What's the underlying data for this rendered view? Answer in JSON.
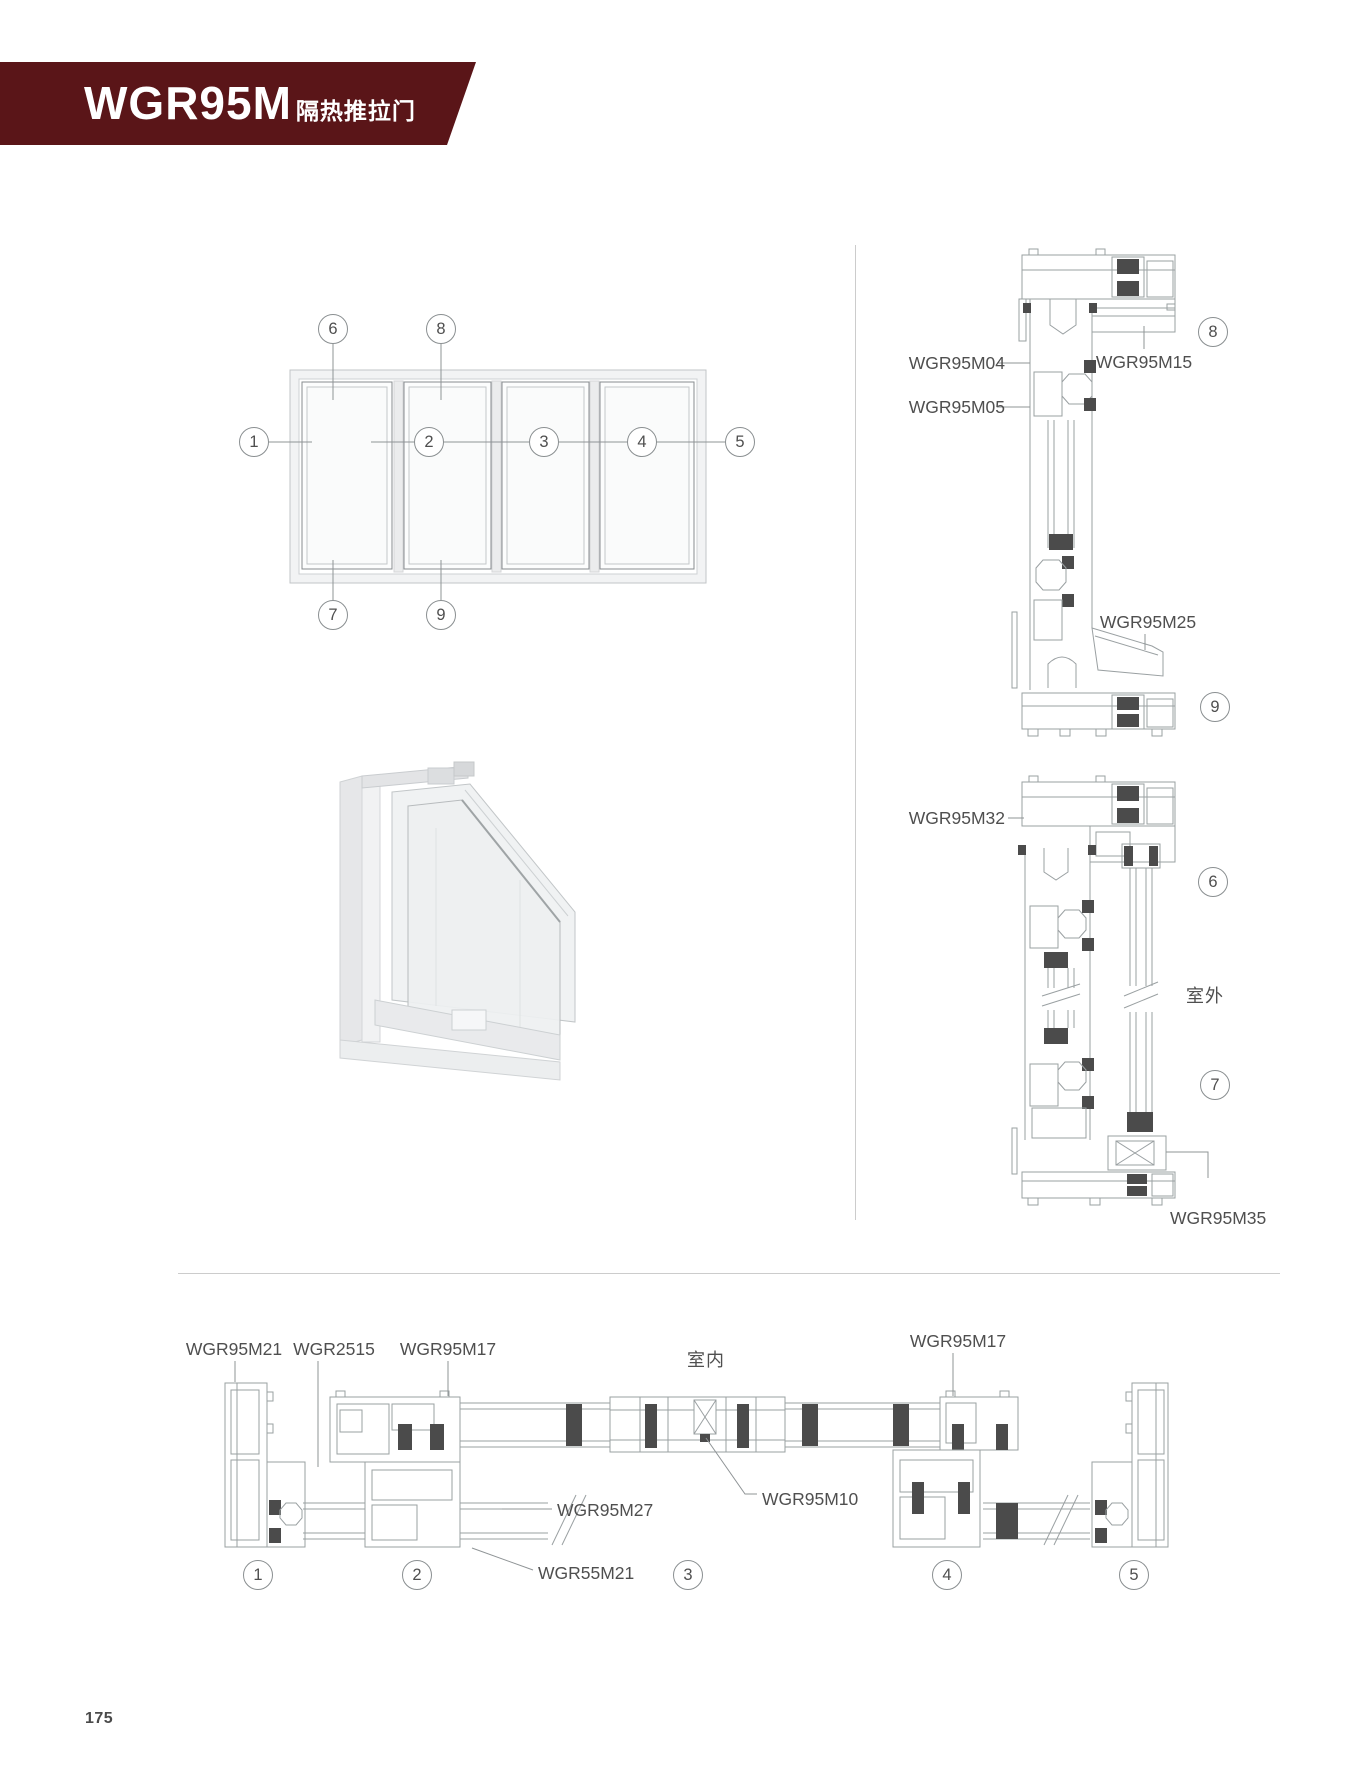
{
  "header": {
    "model": "WGR95M",
    "subtitle": "隔热推拉门",
    "banner_color": "#5a1518"
  },
  "page": {
    "number": "175"
  },
  "annotations": {
    "outdoor": "室外",
    "indoor": "室内"
  },
  "labels": {
    "m04": "WGR95M04",
    "m05": "WGR95M05",
    "m15": "WGR95M15",
    "m25": "WGR95M25",
    "m32": "WGR95M32",
    "m35": "WGR95M35",
    "m21": "WGR95M21",
    "g2515": "WGR2515",
    "m17a": "WGR95M17",
    "m17b": "WGR95M17",
    "m27": "WGR95M27",
    "m10": "WGR95M10",
    "m55": "WGR55M21"
  },
  "callouts": {
    "e1": "1",
    "e2": "2",
    "e3": "3",
    "e4": "4",
    "e5": "5",
    "e6": "6",
    "e7": "7",
    "e8": "8",
    "e9": "9",
    "s8": "8",
    "s9": "9",
    "s6": "6",
    "s7": "7",
    "p1": "1",
    "p2": "2",
    "p3": "3",
    "p4": "4",
    "p5": "5"
  },
  "colors": {
    "banner": "#5a1518",
    "line": "#9aa0a2",
    "dark_gasket": "#4b4b4b",
    "divider": "#cccccc"
  }
}
